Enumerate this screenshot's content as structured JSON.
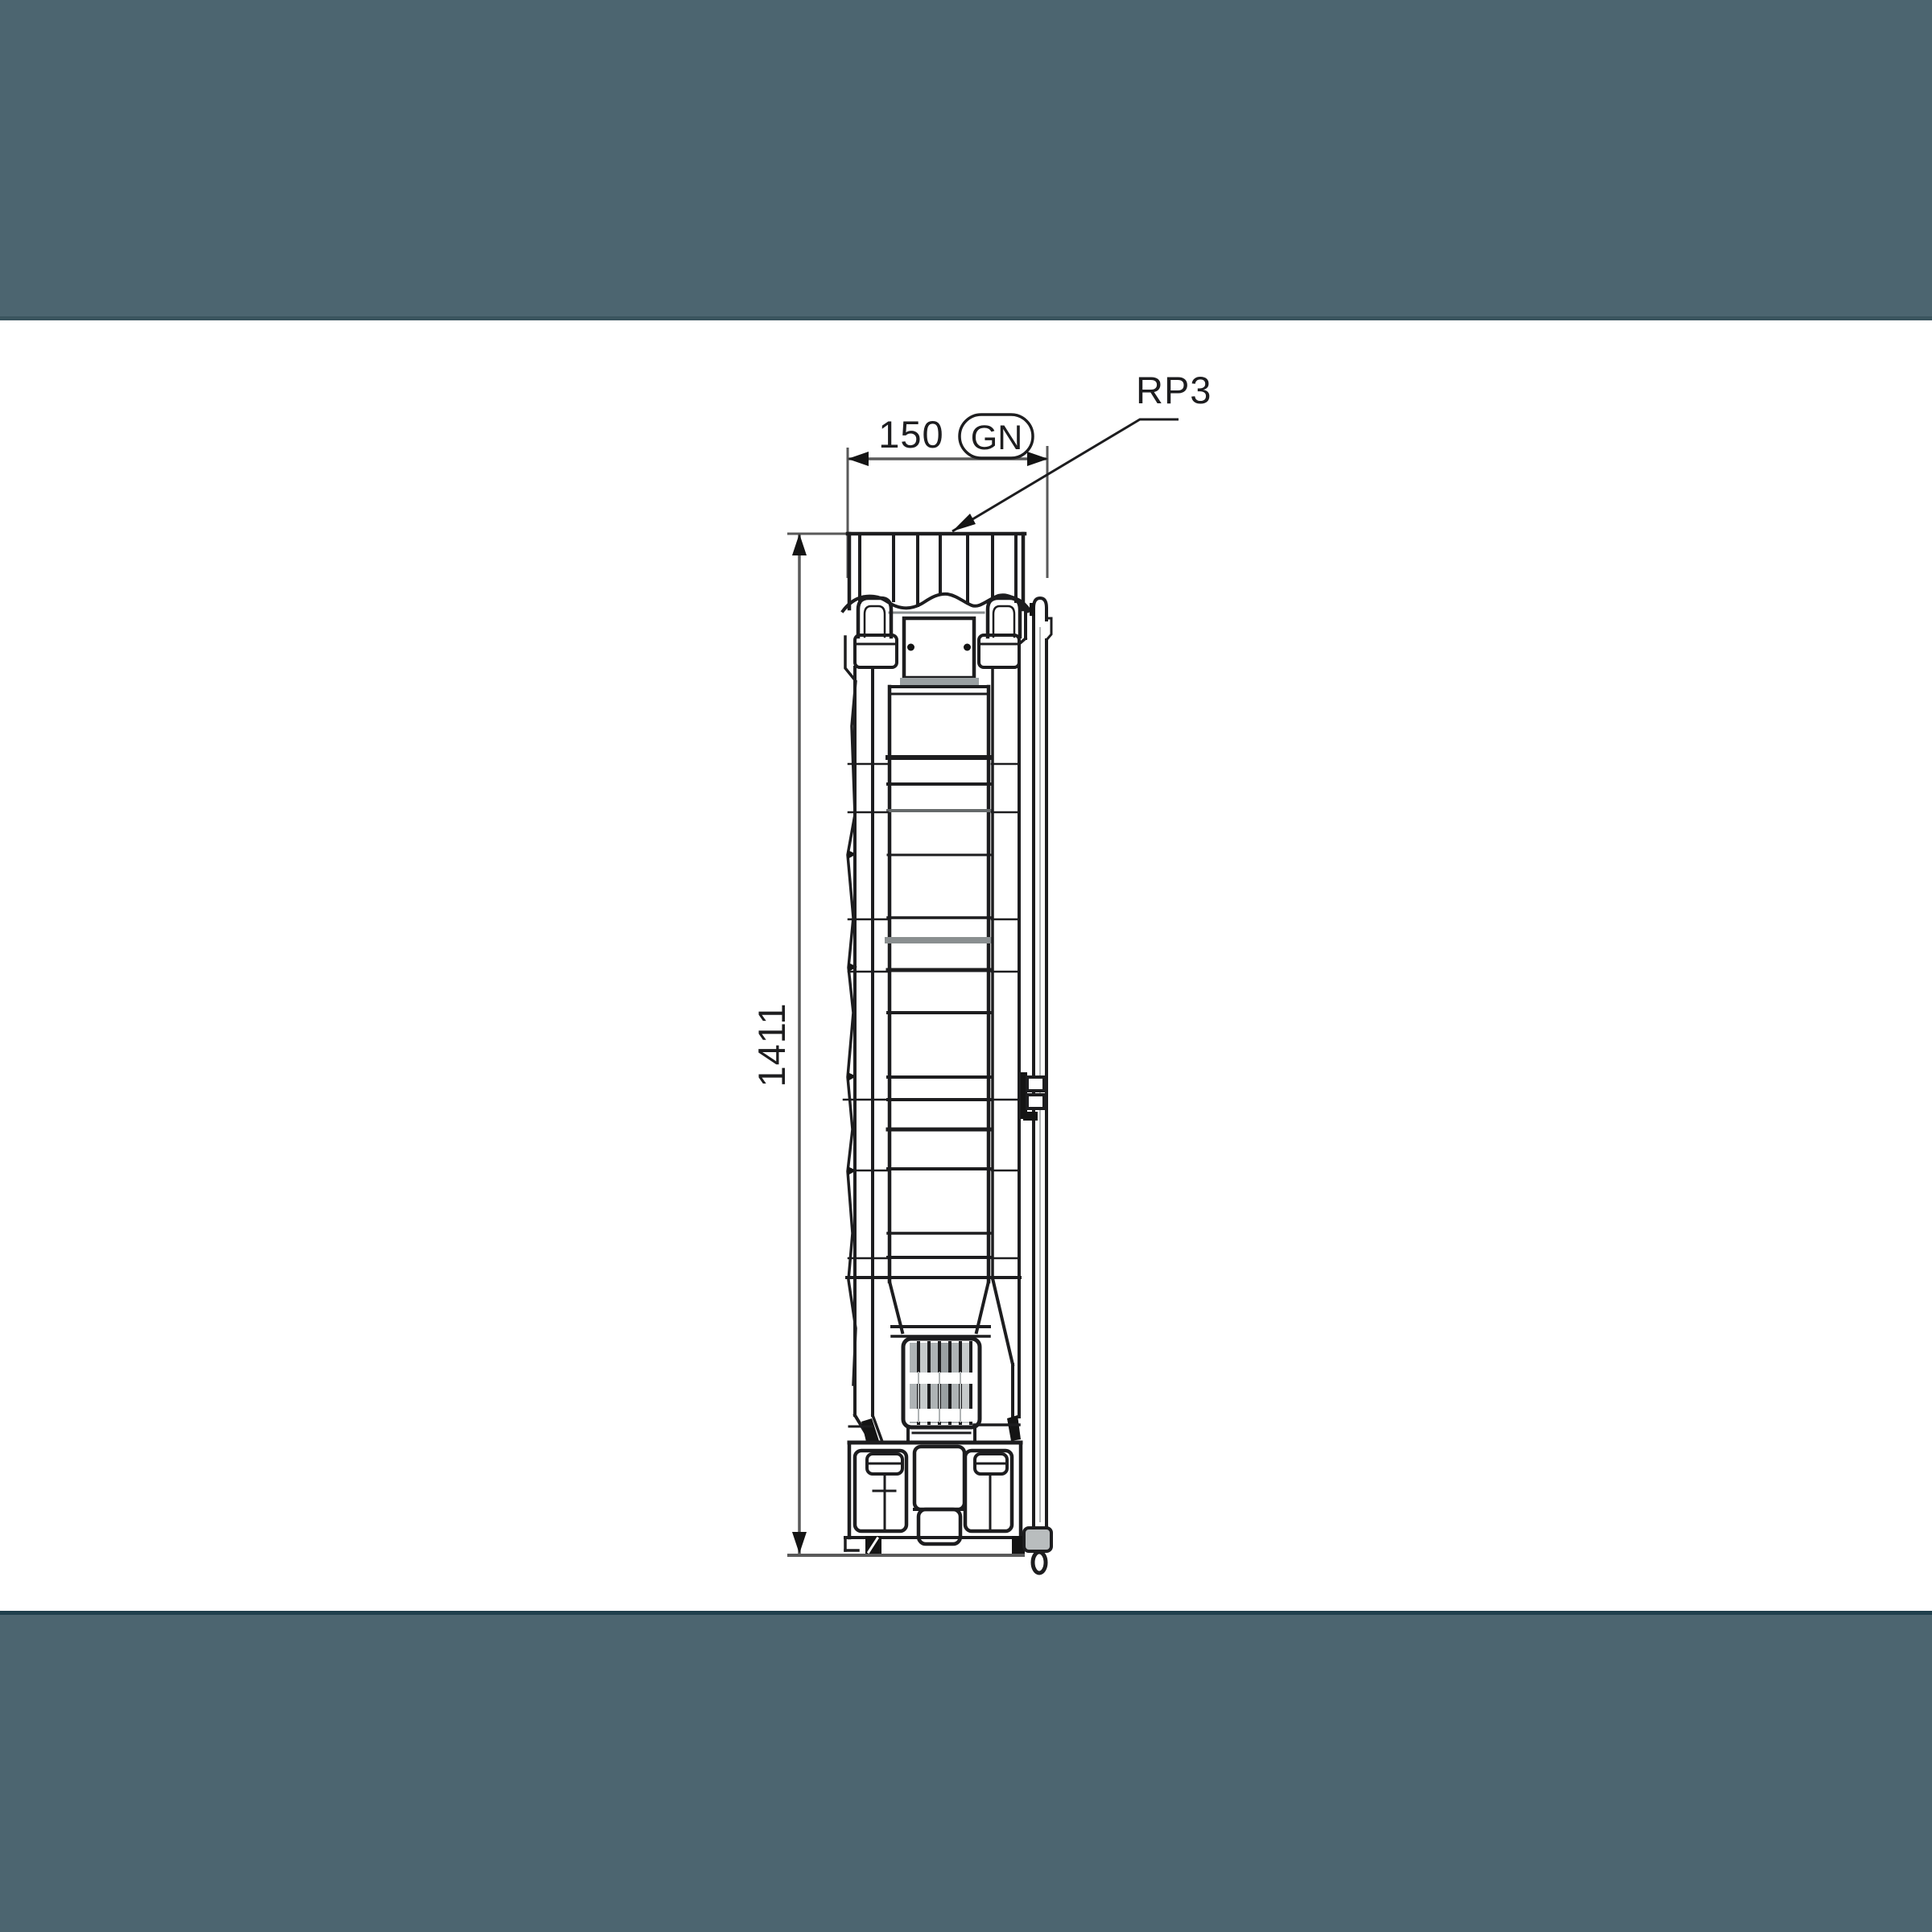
{
  "drawing": {
    "width_dimension": "150",
    "height_dimension": "1411",
    "outlet_badge": "GN",
    "thread_label": "RP3"
  },
  "colors": {
    "band": "#4c6570",
    "band_edge_top": "#3a545e",
    "band_edge_bottom": "#20404d",
    "paper": "#ffffff",
    "line": "#1d1d1f",
    "dim_line": "#5a5a5a",
    "soft_line": "#8a8f90",
    "slot_fill": "#aeb3b5",
    "bracket_fill": "#b9bdbe"
  }
}
